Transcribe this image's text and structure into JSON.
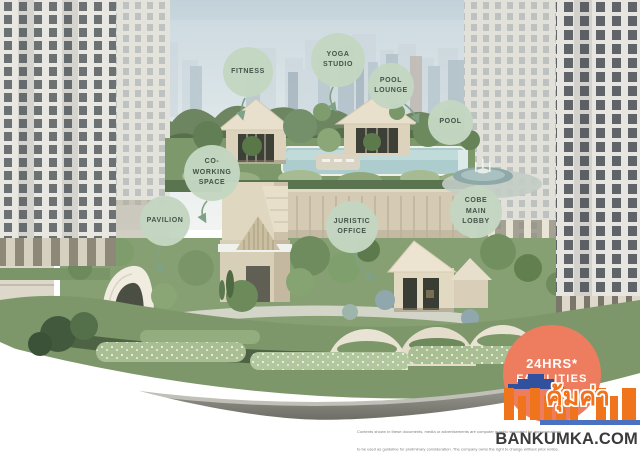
{
  "facilities": [
    {
      "id": "fitness",
      "label": "FITNESS"
    },
    {
      "id": "yoga-studio",
      "label": "YOGA\nSTUDIO"
    },
    {
      "id": "pool-lounge",
      "label": "POOL\nLOUNGE"
    },
    {
      "id": "pool",
      "label": "POOL"
    },
    {
      "id": "co-working-space",
      "label": "CO-\nWORKING\nSPACE"
    },
    {
      "id": "pavilion",
      "label": "PAVILION"
    },
    {
      "id": "juristic-office",
      "label": "JURISTIC\nOFFICE"
    },
    {
      "id": "cobe-main-lobby",
      "label": "COBE\nMAIN\nLOBBY"
    }
  ],
  "badge_24hrs": {
    "line1": "24HRS*",
    "line2": "FACILITIES"
  },
  "watermark": {
    "thai_wordmark": "คุ้มค่า",
    "site": "BANKUMKA.COM"
  },
  "disclaimer": {
    "line1": "Contents shown in these documents, media or advertisements are computer graphic simulated for approximations",
    "line2": "to be used as guideline for preliminary consideration. The company owns the right to change without prior notice."
  },
  "colors": {
    "facility_badge_bg": "#c4d7c2",
    "facility_badge_text": "#3f5046",
    "badge_24hrs_bg": "#ee7d5f",
    "badge_24hrs_text": "#ffffff",
    "logo_orange": "#f2711c",
    "logo_roof_blue": "#31519f",
    "logo_strip_blue": "#4a72c0",
    "site_text": "#3b3b3b"
  }
}
